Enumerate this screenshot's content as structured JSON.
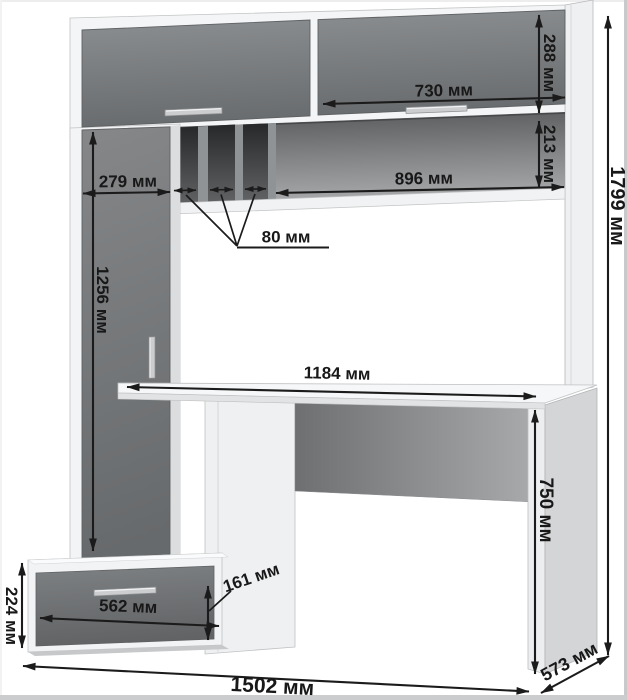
{
  "diagram": {
    "unit_suffix": "мм",
    "dims": {
      "top_door_height": {
        "value": 288,
        "label": "288 мм"
      },
      "top_door_width": {
        "value": 730,
        "label": "730 мм"
      },
      "niche_height": {
        "value": 213,
        "label": "213 мм"
      },
      "niche_width": {
        "value": 896,
        "label": "896 мм"
      },
      "left_column_width": {
        "value": 279,
        "label": "279 мм"
      },
      "slot_width": {
        "value": 80,
        "label": "80 мм"
      },
      "tall_door_height": {
        "value": 1256,
        "label": "1256 мм"
      },
      "desktop_width": {
        "value": 1184,
        "label": "1184 мм"
      },
      "desk_height": {
        "value": 750,
        "label": "750 мм"
      },
      "overall_height": {
        "value": 1799,
        "label": "1799 мм"
      },
      "drawer_unit_height": {
        "value": 224,
        "label": "224 мм"
      },
      "drawer_width": {
        "value": 562,
        "label": "562 мм"
      },
      "drawer_face_height": {
        "value": 161,
        "label": "161 мм"
      },
      "overall_width": {
        "value": 1502,
        "label": "1502 мм"
      },
      "depth": {
        "value": 573,
        "label": "573 мм"
      }
    },
    "colors": {
      "dimension_ink": "#1b1b1b",
      "door_gray": "#717476",
      "carcass_white": "#f2f3f4",
      "interior_dark": "#46484a",
      "background": "#ffffff"
    }
  }
}
